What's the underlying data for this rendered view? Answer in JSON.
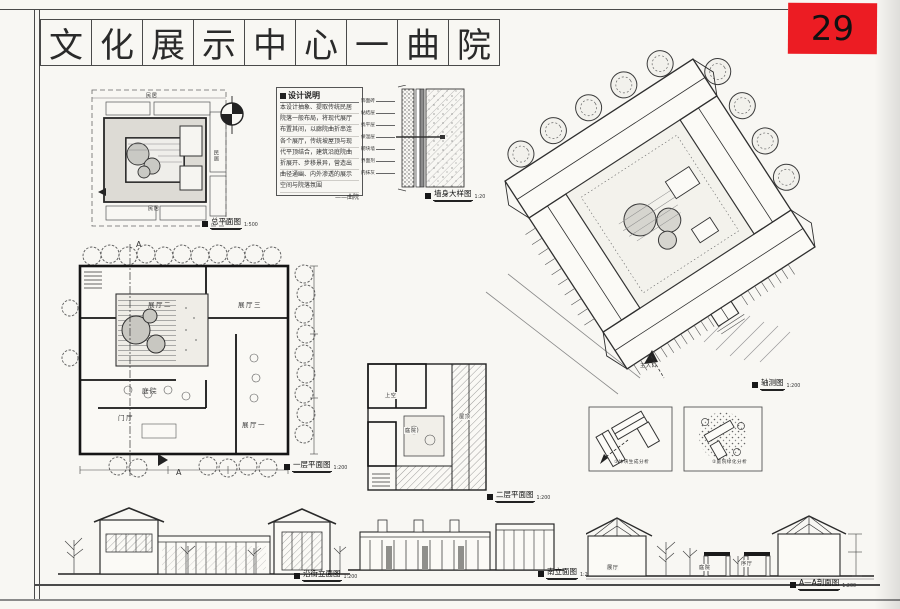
{
  "sheet": {
    "number": "29",
    "badge_color": "#ec1c23"
  },
  "title": {
    "text": "文化展示中心一曲院",
    "chars": [
      "文",
      "化",
      "展",
      "示",
      "中",
      "心",
      "一",
      "曲",
      "院"
    ]
  },
  "notes": {
    "heading": "设计说明",
    "lines": [
      "本设计抽象、提取传统民居",
      "院落一般布局，将现代展厅",
      "布置其间，以廊院曲折串连",
      "各个展厅，传统坡屋顶与现",
      "代平顶结合，建筑沿庭院曲",
      "折展开、步移景异，营造出",
      "曲径通幽、内外渗透的展示",
      "空间与院落氛围"
    ],
    "signature": "——曲院"
  },
  "wall_callouts": [
    "饰面砖",
    "黏结层",
    "找平层",
    "保温层",
    "砌块墙",
    "界面剂",
    "内抹灰"
  ],
  "captions": {
    "site_plan": {
      "label": "总平面图",
      "scale": "1:500"
    },
    "wall_detail": {
      "label": "墙身大样图",
      "scale": "1:20"
    },
    "axon": {
      "label": "轴测图",
      "scale": "1:200"
    },
    "plan1": {
      "label": "一层平面图",
      "scale": "1:200"
    },
    "plan2": {
      "label": "二层平面图",
      "scale": "1:200"
    },
    "analysis1": {
      "label": "①体块生成分析"
    },
    "analysis2": {
      "label": "②庭院绿化分析"
    },
    "elev_street": {
      "label": "沿街立面图",
      "scale": "1:200"
    },
    "elev_south": {
      "label": "南立面图",
      "scale": "1:200"
    },
    "section": {
      "label": "A—A剖面图",
      "scale": "1:200"
    }
  },
  "site": {
    "labels": [
      "民居",
      "民居",
      "民居"
    ]
  },
  "plan1": {
    "hall2": "展厅二",
    "hall3": "展厅三",
    "court": "庭院",
    "lobby": "门厅",
    "hall1": "展厅一",
    "mark_top": "A",
    "mark_bottom": "A"
  },
  "plan2": {
    "void": "上空",
    "court": "庭院",
    "roof": "屋顶"
  },
  "axon": {
    "entrance": "主入口"
  },
  "section_labels": {
    "left": "展厅",
    "mid": "庭院",
    "right": "序厅"
  }
}
